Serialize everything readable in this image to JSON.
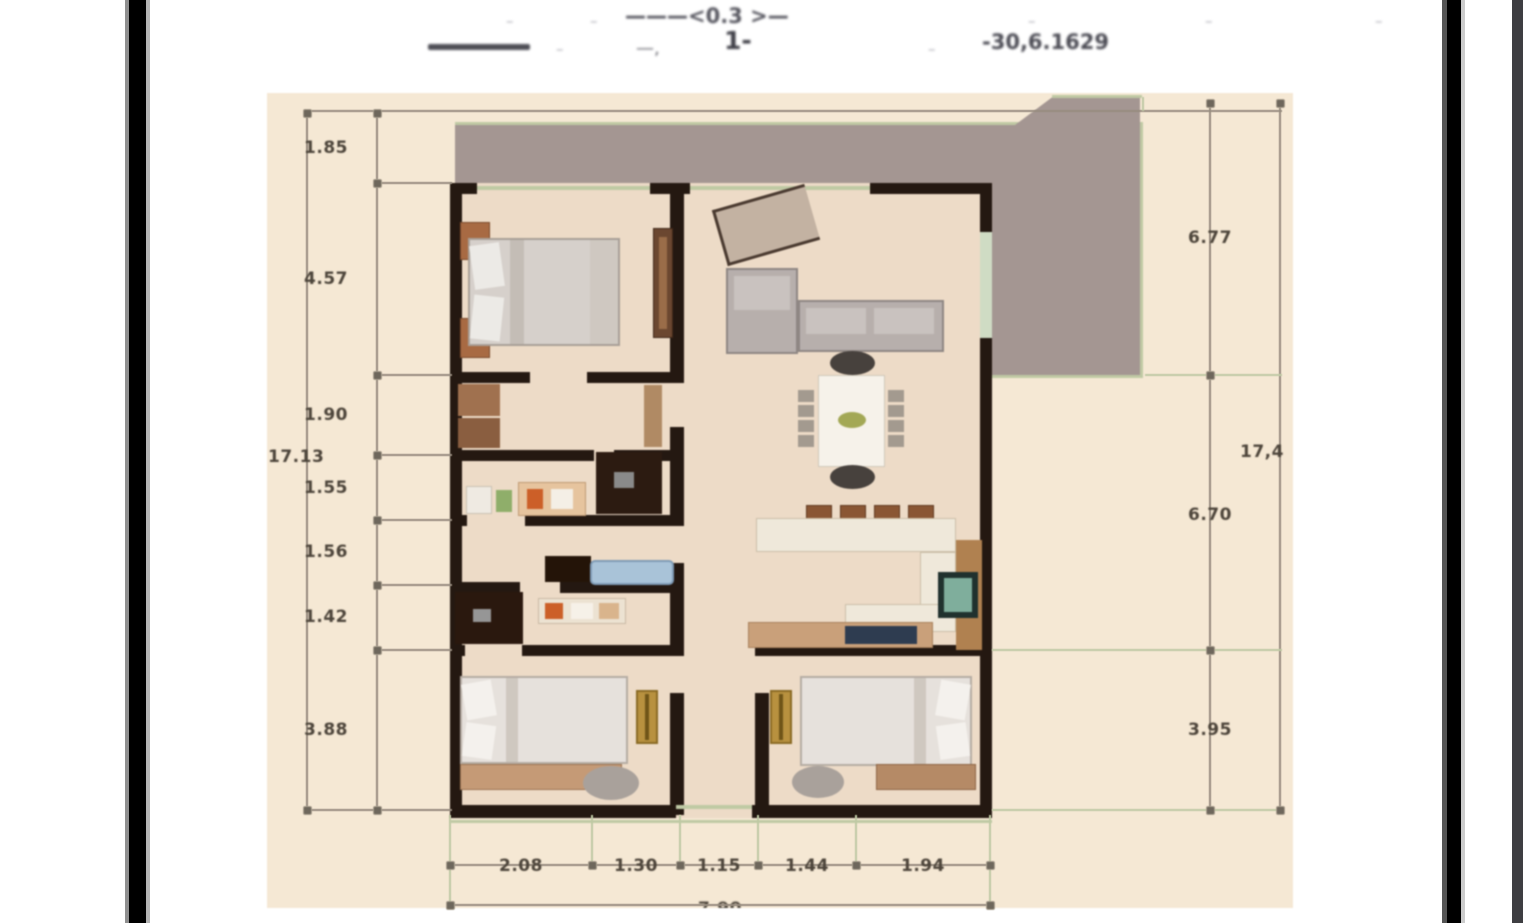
{
  "document": {
    "type": "floor-plan-scan",
    "header": {
      "line1": [
        "–",
        "–",
        "———<0.3 >—",
        "–",
        "–",
        "–"
      ],
      "line2": [
        "–",
        "—,",
        "1-",
        "–",
        "-30,6.1629"
      ]
    },
    "dims": {
      "left_chain": [
        "1.85",
        "4.57",
        "1.90",
        "1.55",
        "1.56",
        "1.42",
        "3.88"
      ],
      "left_total": "17.13",
      "right_chain": [
        "6.77",
        "6.70",
        "3.95"
      ],
      "right_total": "17,4",
      "bottom_chain": [
        "2.08",
        "1.30",
        "1.15",
        "1.44",
        "1.94"
      ],
      "bottom_total": "7.90"
    },
    "rooms": [
      "terrace",
      "bedroom-top-left",
      "living-dining-room",
      "kitchen",
      "hall-study",
      "bathroom",
      "bedroom-bottom-left",
      "bedroom-bottom-right",
      "corridor"
    ],
    "colors": {
      "paper": "#f5e8d4",
      "terrace_gray": "#a49692",
      "wall_black": "#241811",
      "outline_sage": "#bfc9a4",
      "dimension_line": "#978c7f",
      "dimension_text": "#4c443a",
      "frame_bar": "#000000",
      "right_edge_strip": "#3e3e42",
      "wood_accent": "#a86a43",
      "gold_wardrobe": "#b8913f",
      "bathtub_blue": "#a9c3d8",
      "appliance_teal": "#7fae9c",
      "navy_counter_item": "#2e3c50"
    }
  }
}
